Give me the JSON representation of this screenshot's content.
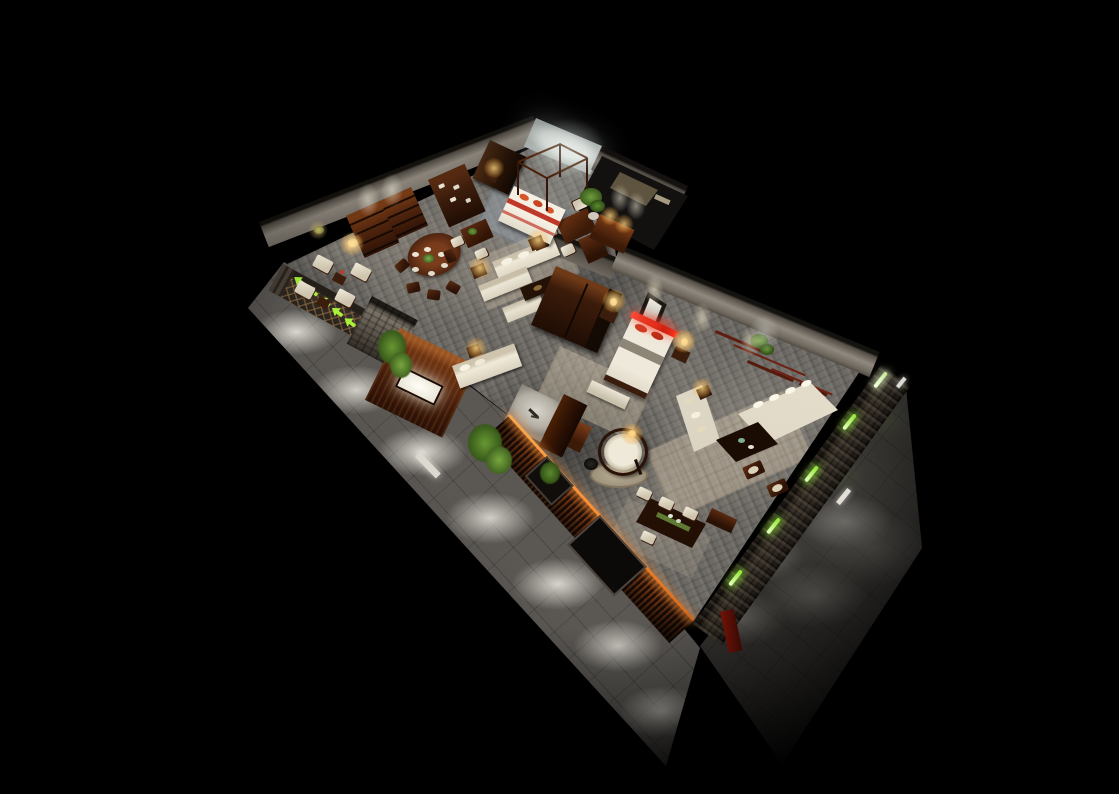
{
  "meta": {
    "title": "Night-time isometric 3D cutaway rendering of a new-Chinese-style furniture showroom floating in a black void",
    "type": "architectural-interior-render",
    "view": "bird's-eye cutaway, no visible text or UI"
  },
  "palette": {
    "background": "#000000",
    "interior_floor": "#6e6b66",
    "walkway_tile": "#77746f",
    "stone_wall": "#3a332b",
    "interior_wall": "#938d84",
    "backlit_wall": "#f5f7f2",
    "wood_dark": "#2b150a",
    "wood_mid": "#5a2a10",
    "wood_warm": "#8a4a1e",
    "upholstery_cream": "#eae4d4",
    "rug_beige": "#cdc2ac",
    "rug_blue_gray": "#96a0aa",
    "accent_green_neon": "#9ef336",
    "plant_green": "#55892e",
    "accent_red": "#e13a26",
    "lamp_glow": "#ffd27a",
    "cove_amber": "#ff9d42"
  },
  "signage": {
    "green_arrow_signs": 5,
    "green_neon_wall_strips": 5,
    "walkway_light_pools": 7
  },
  "rooms": [
    {
      "name": "dining-display",
      "objects": [
        "round dining table with plates and flower centerpiece",
        "five dark wood chairs",
        "two etagere display shelves",
        "tall bookcase with papers",
        "square tea table with chairs",
        "four cream armchairs with side tables",
        "floor lamp"
      ]
    },
    {
      "name": "canopy-bed-suite",
      "objects": [
        "four-poster canopy bed with red pillows",
        "backlit white headboard wall",
        "dark wardrobe",
        "potted plant",
        "wall console with twin spotlights",
        "bedside lamp table"
      ]
    },
    {
      "name": "lounge-display",
      "objects": [
        "two cream sofas with chaise",
        "dark coffee table",
        "two lamp side tables",
        "display daybed behind backlit wood panel",
        "white art alcove with bench",
        "dark wood column"
      ]
    },
    {
      "name": "bedroom-display",
      "objects": [
        "bed with glowing red headboard strip",
        "two nightstands with lamps",
        "framed artwork",
        "foot bench with tray",
        "area rug",
        "large junction wardrobe"
      ]
    },
    {
      "name": "living-room-display",
      "objects": [
        "two cream sofas facing a dark coffee table",
        "patterned area rug",
        "branch wall art with hanging plant",
        "two wooden armchairs",
        "three wall sconces"
      ]
    },
    {
      "name": "tea-corner",
      "objects": [
        "tea desk with green runner",
        "four white-cushion chairs",
        "round rattan hanging chair",
        "round rug",
        "black water jar",
        "pendant lamp",
        "side cabinet"
      ]
    }
  ],
  "exterior": {
    "features": [
      "white tiled walkway with pools of downlight along the south-west side",
      "white tiled apron on the east side",
      "dark rubble-stone perimeter walls",
      "green neon strips along the east stone wall",
      "five green arrow signs at the west entrance wall",
      "lattice screen panels",
      "stone pillar",
      "vertical timber-slat facade with amber cove lighting and dark windows",
      "backlit display panel with white light slot",
      "bamboo plants",
      "recessed floor light bars"
    ]
  }
}
